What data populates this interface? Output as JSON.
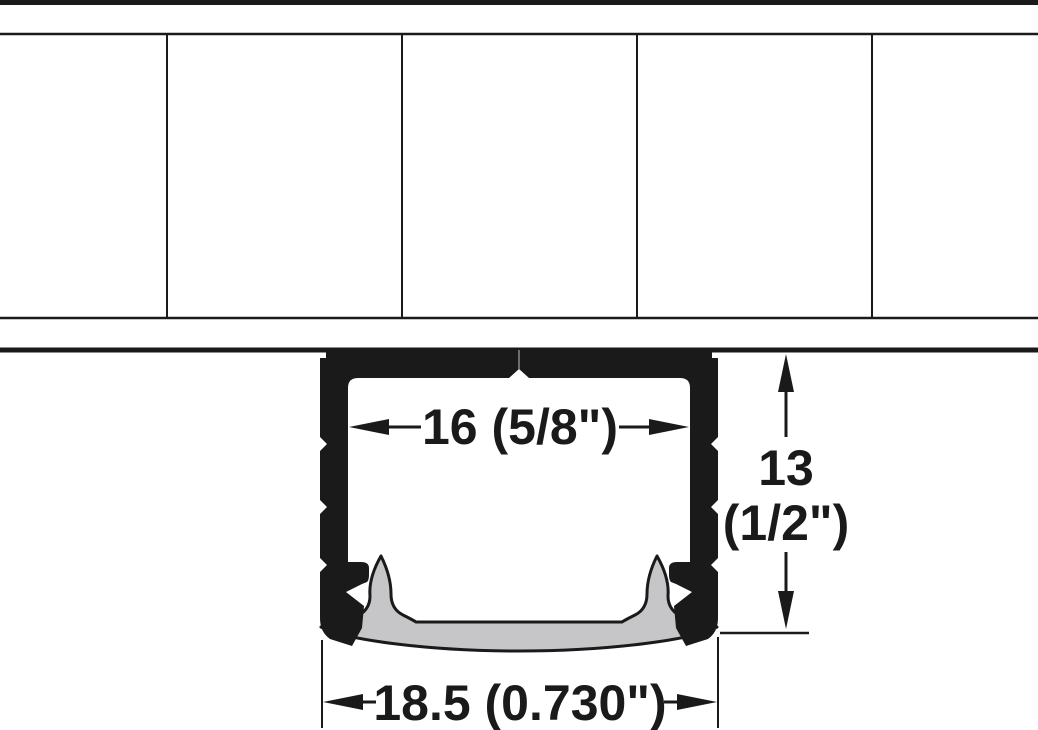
{
  "diagram": {
    "title": "LED aluminum profile cross-section, surface-mounted under panel",
    "dimensions": {
      "inner_width_label": "16 (5/8\")",
      "height_label_value": "13",
      "height_label_fraction": "(1/2\")",
      "outer_width_label": "18.5 (0.730\")"
    },
    "colors": {
      "line": "#1a1a1b",
      "diffuser_fill": "#c6c6c9",
      "background": "#ffffff",
      "center_seam": "#8a8a8a"
    }
  }
}
